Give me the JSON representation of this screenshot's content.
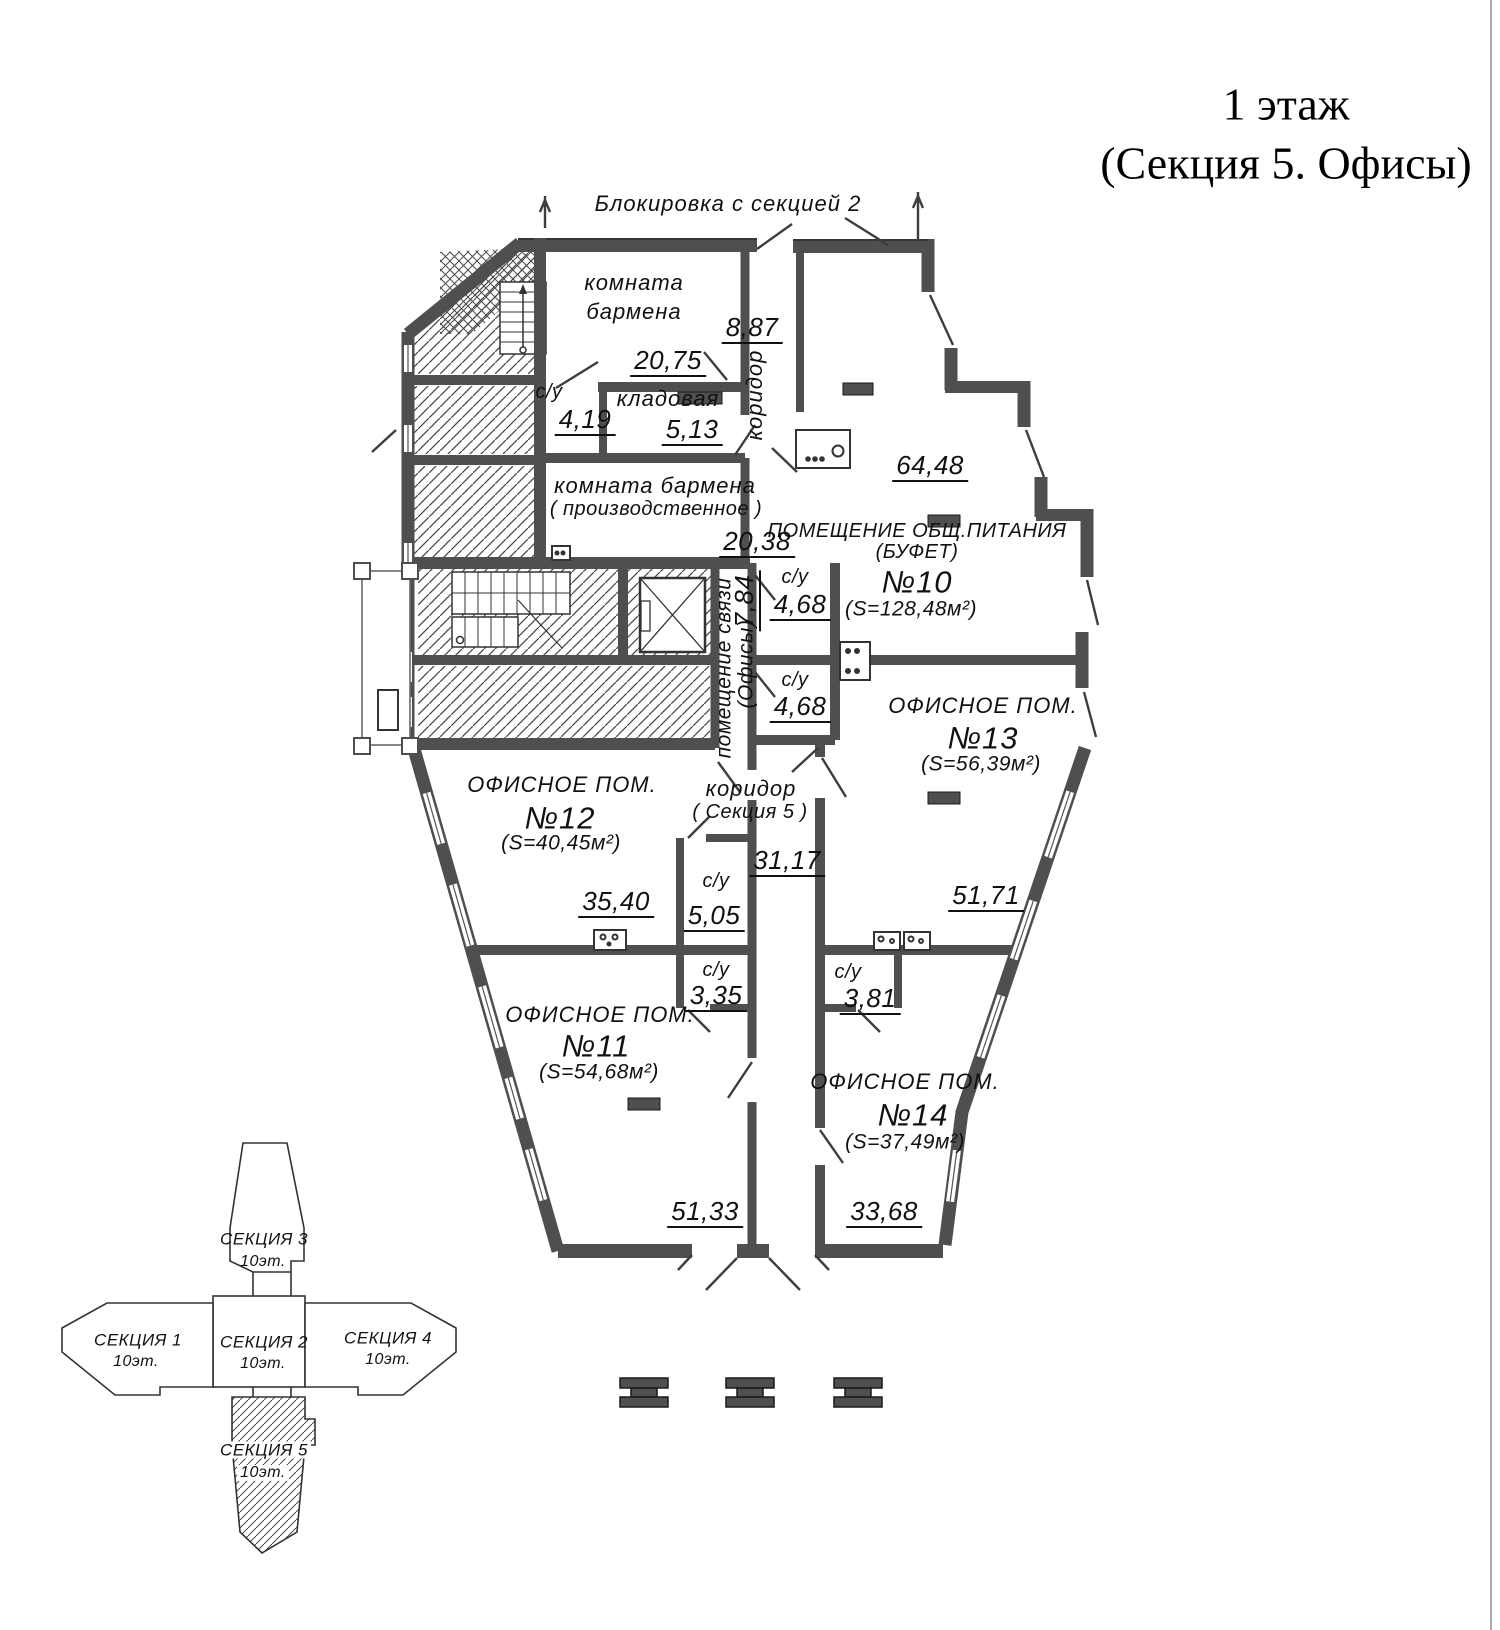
{
  "title": {
    "line1": "1 этаж",
    "line2": "(Секция 5. Офисы)"
  },
  "annotations": {
    "blocking": "Блокировка с секцией 2"
  },
  "rooms": {
    "bartender": {
      "name1": "комната",
      "name2": "бармена",
      "dim": "20,75"
    },
    "corridor_top": {
      "name": "коридор",
      "dim": "8,87"
    },
    "su_419": {
      "name": "с/у",
      "dim": "4,19"
    },
    "kladovaya": {
      "name": "кладовая",
      "dim": "5,13"
    },
    "bartender_prod": {
      "name1": "комната бармена",
      "name2": "( производственное )",
      "dim": "20,38"
    },
    "buffet": {
      "name1": "ПОМЕЩЕНИЕ ОБЩ.ПИТАНИЯ",
      "name2": "(БУФЕТ)",
      "number": "№10",
      "area": "(S=128,48м²)",
      "dim": "64,48"
    },
    "su_468a": {
      "name": "с/у",
      "dim": "4,68"
    },
    "su_468b": {
      "name": "с/у",
      "dim": "4,68"
    },
    "svyaz": {
      "name": "помещение связи",
      "name2": "(Офисы)",
      "dim": "7,84"
    },
    "office13": {
      "name": "ОФИСНОЕ ПОМ.",
      "number": "№13",
      "area": "(S=56,39м²)",
      "dim": "51,71"
    },
    "office12": {
      "name": "ОФИСНОЕ ПОМ.",
      "number": "№12",
      "area": "(S=40,45м²)",
      "dim": "35,40"
    },
    "corridor5": {
      "name1": "коридор",
      "name2": "( Секция 5 )",
      "dim": "31,17"
    },
    "su_505": {
      "name": "с/у",
      "dim": "5,05"
    },
    "su_335": {
      "name": "с/у",
      "dim": "3,35"
    },
    "su_381": {
      "name": "с/у",
      "dim": "3,81"
    },
    "office11": {
      "name": "ОФИСНОЕ ПОМ.",
      "number": "№11",
      "area": "(S=54,68м²)",
      "dim": "51,33"
    },
    "office14": {
      "name": "ОФИСНОЕ ПОМ.",
      "number": "№14",
      "area": "(S=37,49м²)",
      "dim": "33,68"
    }
  },
  "key_plan": {
    "section3": {
      "name": "СЕКЦИЯ 3",
      "floors": "10эт."
    },
    "section1": {
      "name": "СЕКЦИЯ 1",
      "floors": "10эт."
    },
    "section2": {
      "name": "СЕКЦИЯ 2",
      "floors": "10эт."
    },
    "section4": {
      "name": "СЕКЦИЯ 4",
      "floors": "10эт."
    },
    "section5": {
      "name": "СЕКЦИЯ 5",
      "floors": "10эт."
    }
  },
  "colors": {
    "wall": "#4f4f4f",
    "line": "#1a1a1a",
    "text": "#111111"
  }
}
